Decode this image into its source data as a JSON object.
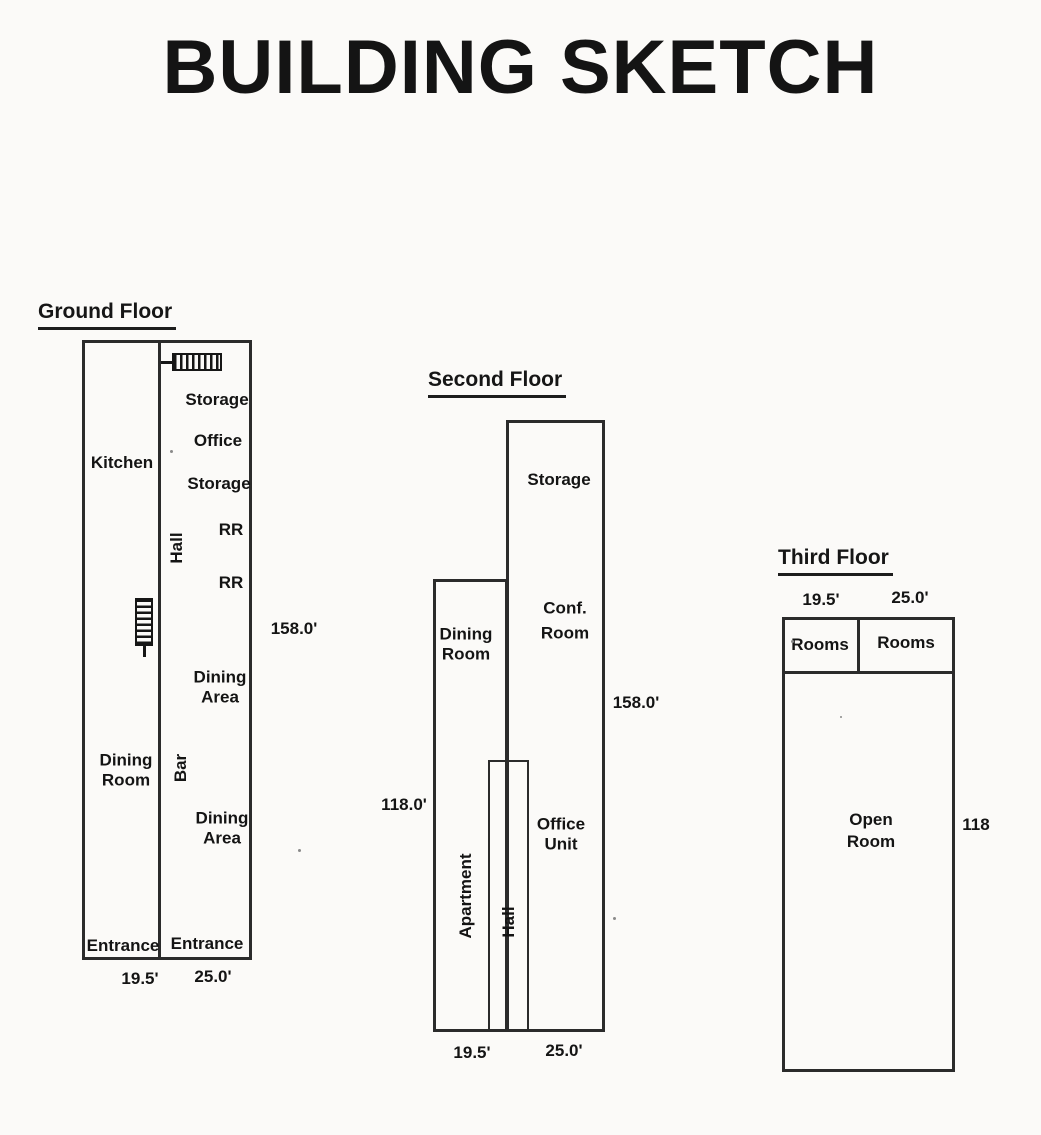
{
  "page": {
    "title": "BUILDING SKETCH"
  },
  "colors": {
    "ink": "#1f1f1f",
    "paper": "#fbfaf8"
  },
  "icons": {
    "ground_stairs_top": "stairs-icon",
    "ground_stairs_mid": "stairs-icon"
  },
  "ground_floor": {
    "heading": "Ground Floor",
    "labels": {
      "kitchen": "Kitchen",
      "storage_top": "Storage",
      "office": "Office",
      "storage_mid": "Storage",
      "rr_upper": "RR",
      "rr_lower": "RR",
      "hall": "Hall",
      "dining_area_upper": "Dining Area",
      "dining_room": "Dining Room",
      "bar": "Bar",
      "dining_area_lower": "Dining Area",
      "entrance_left": "Entrance",
      "entrance_right": "Entrance"
    },
    "dimensions": {
      "depth": "158.0'",
      "left_width": "19.5'",
      "right_width": "25.0'"
    }
  },
  "second_floor": {
    "heading": "Second Floor",
    "labels": {
      "storage": "Storage",
      "conf_room": "Conf. Room",
      "dining_room": "Dining Room",
      "office_unit": "Office Unit",
      "apartment": "Apartment",
      "hall": "Hall"
    },
    "dimensions": {
      "right_depth": "158.0'",
      "left_depth": "118.0'",
      "left_width": "19.5'",
      "right_width": "25.0'"
    }
  },
  "third_floor": {
    "heading": "Third Floor",
    "labels": {
      "rooms_left": "Rooms",
      "rooms_right": "Rooms",
      "open_room": "Open Room"
    },
    "dimensions": {
      "left_width": "19.5'",
      "right_width": "25.0'",
      "depth": "118"
    }
  }
}
